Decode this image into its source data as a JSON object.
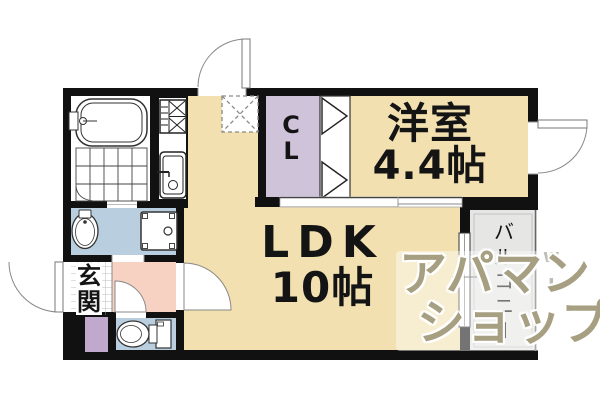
{
  "floorplan": {
    "rooms": {
      "western": {
        "name": "洋室",
        "size": "4.4帖"
      },
      "ldk": {
        "name": "LDK",
        "size": "10帖"
      },
      "closet": {
        "chars": [
          "C",
          "L"
        ]
      },
      "balcony": {
        "chars": [
          "バ",
          "ル",
          "コ",
          "ニ",
          "ー"
        ]
      },
      "entrance": {
        "chars": [
          "玄",
          "関"
        ]
      }
    },
    "watermark": {
      "line1": "アパマン",
      "line2": "ショップ",
      "mark1": "w",
      "mark2": "L"
    },
    "colors": {
      "floor_beige": "#f2e0b0",
      "closet_lavender": "#cfc3d9",
      "cabinet_purple": "#c0a9cc",
      "hall_pink": "#f7d2c2",
      "wet_area_blue": "#b9cfdf",
      "balcony_gray": "#e6e6e4",
      "wall_black": "#111111",
      "watermark_khaki": "#978e6b"
    }
  }
}
